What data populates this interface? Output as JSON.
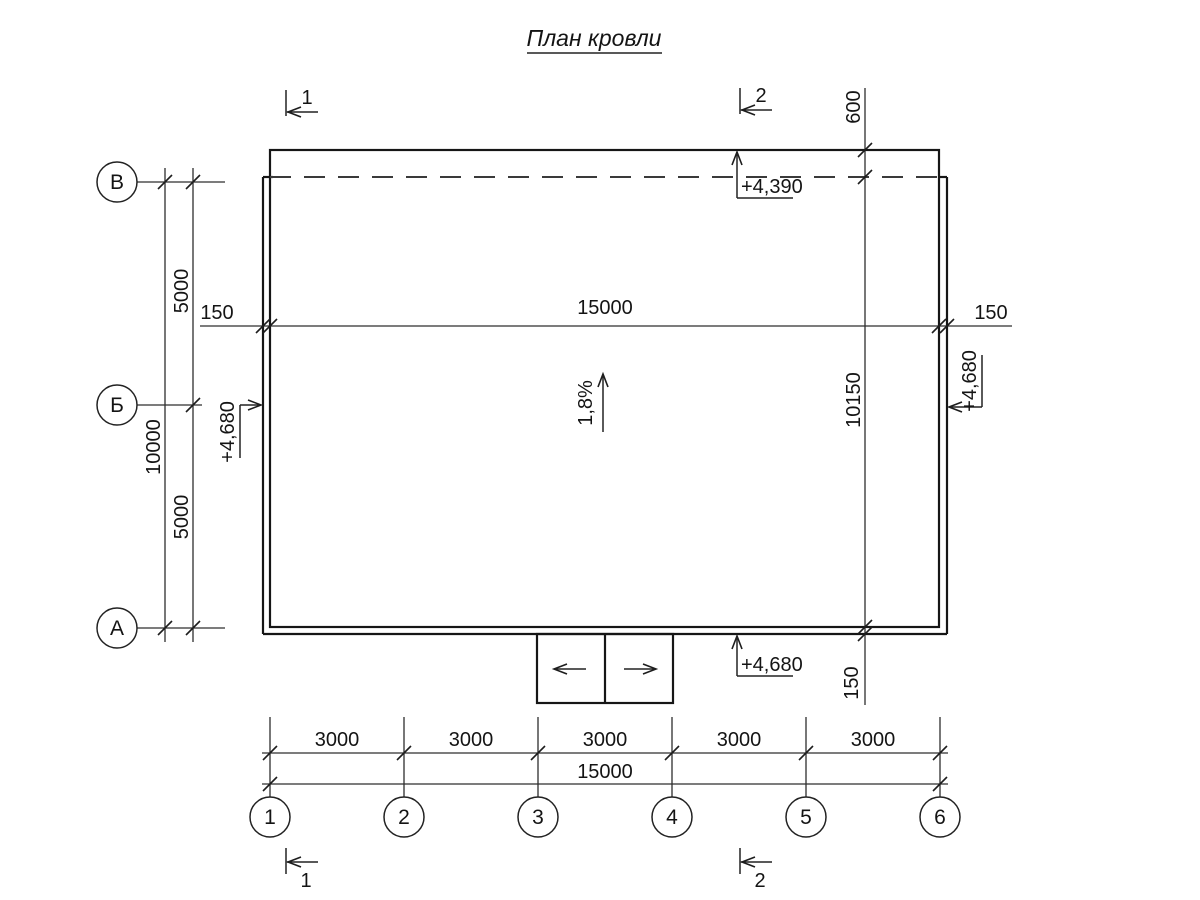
{
  "title": "План кровли",
  "grid": {
    "rows": [
      "В",
      "Б",
      "А"
    ],
    "columns": [
      "1",
      "2",
      "3",
      "4",
      "5",
      "6"
    ]
  },
  "dims": {
    "top_left_150": "150",
    "top_15000": "15000",
    "top_right_150": "150",
    "left_upper_5000": "5000",
    "left_10000": "10000",
    "left_lower_5000": "5000",
    "right_600": "600",
    "right_10150": "10150",
    "right_150": "150",
    "bottom_spans": [
      "3000",
      "3000",
      "3000",
      "3000",
      "3000"
    ],
    "bottom_total": "15000"
  },
  "elevations": {
    "top": "+4,390",
    "left": "+4,680",
    "right": "+4,680",
    "bottom": "+4,680"
  },
  "slope_label": "1,8%",
  "section_marks": {
    "mark1": "1",
    "mark2": "2"
  }
}
